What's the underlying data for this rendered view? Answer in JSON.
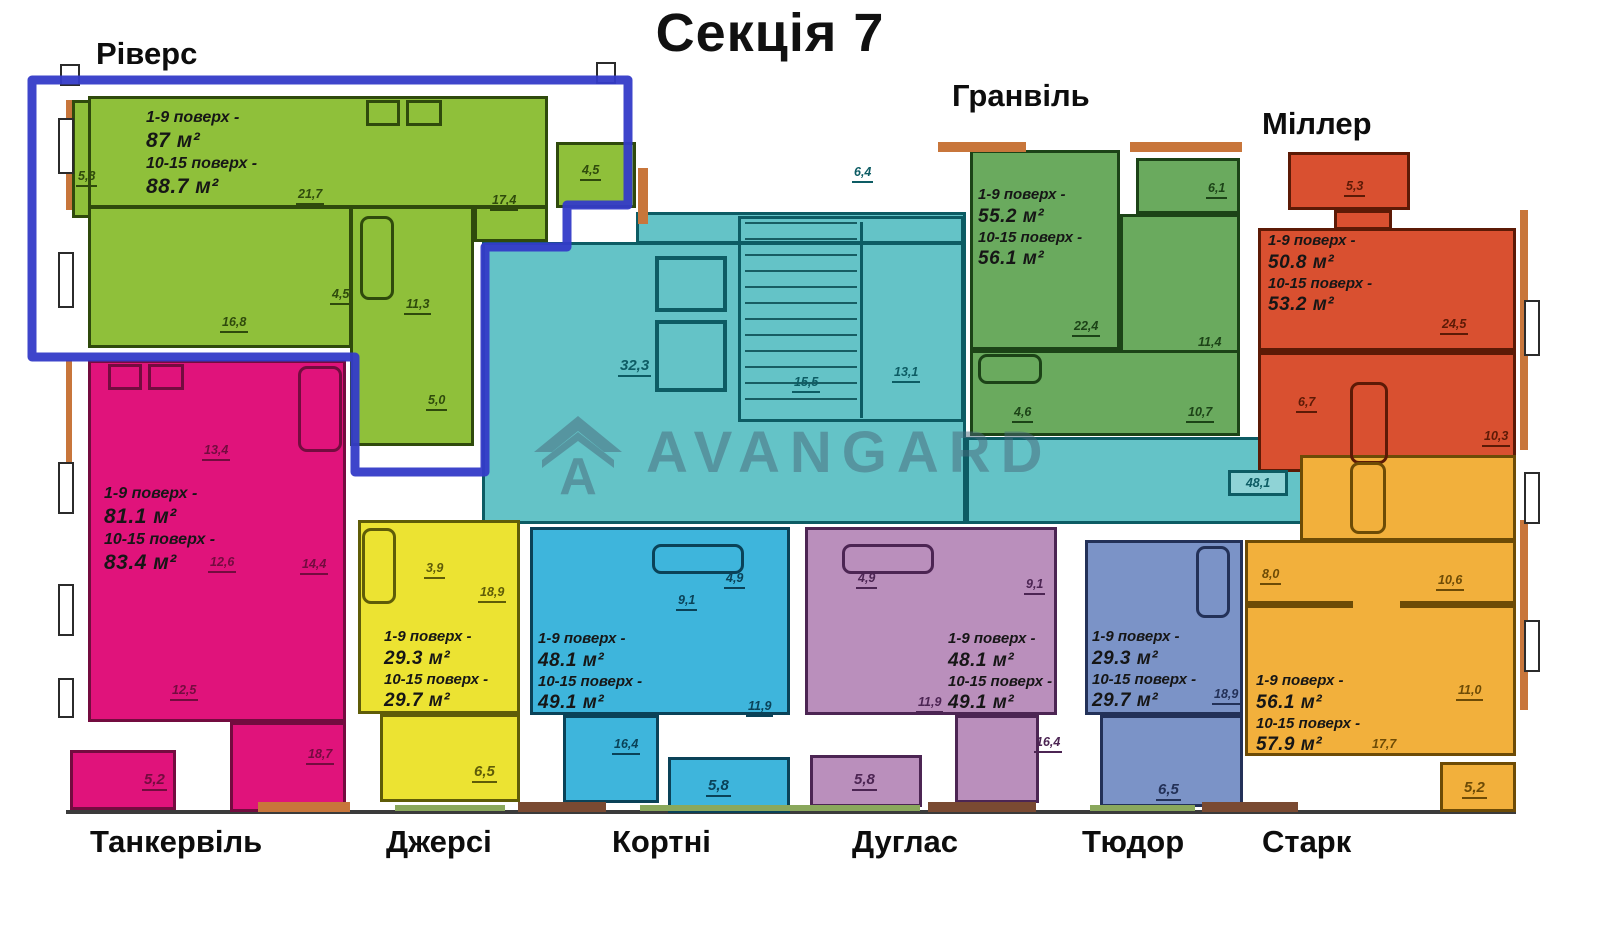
{
  "title": "Секція 7",
  "watermark": {
    "text": "AVANGARD",
    "color": "rgba(72,104,122,0.5)"
  },
  "highlight": {
    "color": "#343bc8",
    "target": "Ріверс"
  },
  "apartments": [
    {
      "name": "Ріверс",
      "floors1": "1-9 поверх -",
      "area1": "87 м²",
      "floors2": "10-15 поверх -",
      "area2": "88.7 м²",
      "fill": "#8fc03a",
      "wall": "#2f4a0c",
      "dims": [
        "5,8",
        "21,7",
        "17,4",
        "4,5",
        "16,8",
        "4,5",
        "11,3",
        "5,0"
      ]
    },
    {
      "name": "Гранвіль",
      "floors1": "1-9 поверх -",
      "area1": "55.2 м²",
      "floors2": "10-15 поверх -",
      "area2": "56.1 м²",
      "fill": "#6aaa5e",
      "wall": "#1c4317",
      "dims": [
        "6,1",
        "22,4",
        "11,4",
        "4,6",
        "10,7"
      ]
    },
    {
      "name": "Міллер",
      "floors1": "1-9 поверх -",
      "area1": "50.8 м²",
      "floors2": "10-15 поверх -",
      "area2": "53.2 м²",
      "fill": "#d95030",
      "wall": "#5c1a06",
      "dims": [
        "5,3",
        "24,5",
        "6,7",
        "10,3"
      ]
    },
    {
      "name": "Танкервіль",
      "floors1": "1-9 поверх -",
      "area1": "81.1 м²",
      "floors2": "10-15 поверх -",
      "area2": "83.4 м²",
      "fill": "#e0137b",
      "wall": "#730c3f",
      "dims": [
        "13,4",
        "12,6",
        "14,4",
        "12,5",
        "18,7",
        "5,2"
      ]
    },
    {
      "name": "Джерсі",
      "floors1": "1-9 поверх -",
      "area1": "29.3 м²",
      "floors2": "10-15 поверх -",
      "area2": "29.7 м²",
      "fill": "#ece332",
      "wall": "#5f5c08",
      "dims": [
        "3,9",
        "18,9",
        "6,5"
      ]
    },
    {
      "name": "Кортні",
      "floors1": "1-9 поверх -",
      "area1": "48.1 м²",
      "floors2": "10-15 поверх -",
      "area2": "49.1 м²",
      "fill": "#3eb5dc",
      "wall": "#0a4258",
      "dims": [
        "9,1",
        "4,9",
        "11,9",
        "16,4",
        "5,8"
      ]
    },
    {
      "name": "Дуглас",
      "floors1": "1-9 поверх -",
      "area1": "48.1 м²",
      "floors2": "10-15 поверх -",
      "area2": "49.1 м²",
      "fill": "#ba8fbc",
      "wall": "#4c2553",
      "dims": [
        "4,9",
        "9,1",
        "11,9",
        "16,4",
        "5,8"
      ]
    },
    {
      "name": "Тюдор",
      "floors1": "1-9 поверх -",
      "area1": "29.3 м²",
      "floors2": "10-15 поверх -",
      "area2": "29.7 м²",
      "fill": "#7b93c7",
      "wall": "#233158",
      "dims": [
        "18,9",
        "6,5"
      ]
    },
    {
      "name": "Старк",
      "floors1": "1-9 поверх -",
      "area1": "56.1 м²",
      "floors2": "10-15 поверх -",
      "area2": "57.9 м²",
      "fill": "#f2b03c",
      "wall": "#6d4b06",
      "dims": [
        "8,0",
        "10,6",
        "11,0",
        "17,7",
        "5,2"
      ]
    }
  ],
  "common": {
    "fill": "#64c3c7",
    "wall": "#0d5c64",
    "dims": [
      "6,4",
      "32,3",
      "15,5",
      "13,1",
      "48,1"
    ]
  }
}
